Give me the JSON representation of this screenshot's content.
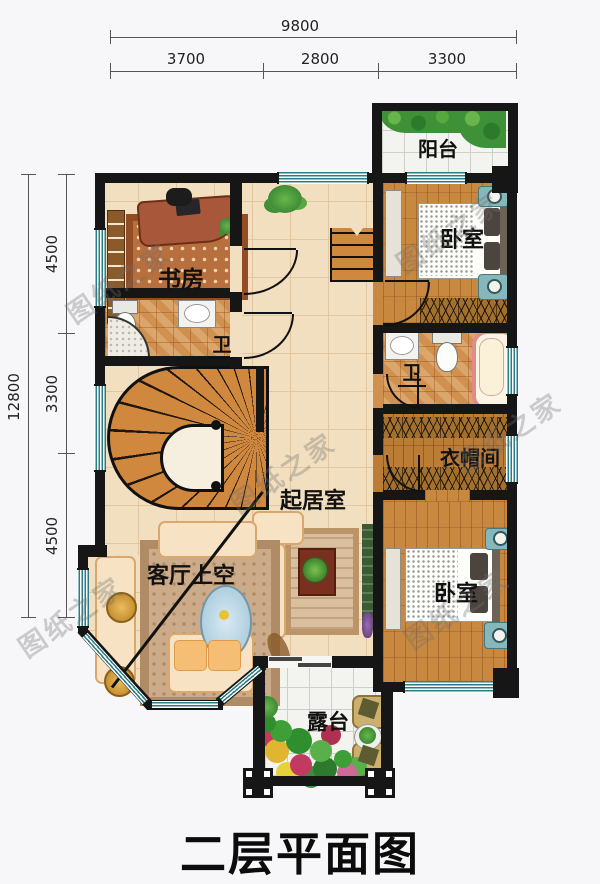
{
  "title": "二层平面图",
  "watermark": "图纸之家",
  "dimensions": {
    "top": {
      "total": "9800",
      "segments": [
        "3700",
        "2800",
        "3300"
      ]
    },
    "left": {
      "total": "12800",
      "segments": [
        "4500",
        "3300",
        "4500"
      ]
    }
  },
  "rooms": {
    "balcony": {
      "label": "阳台"
    },
    "bedroom_top": {
      "label": "卧室"
    },
    "study": {
      "label": "书房"
    },
    "bath_top": {
      "label": "卫"
    },
    "bath_mid": {
      "label": "卫"
    },
    "closet": {
      "label": "衣帽间"
    },
    "living": {
      "label": "起居室"
    },
    "living_void": {
      "label": "客厅上空"
    },
    "bedroom_bottom": {
      "label": "卧室"
    },
    "terrace": {
      "label": "露台"
    }
  },
  "colors": {
    "wall": "#161616",
    "window_teal": "#2a7d85",
    "wood_floor": "#c9883f",
    "cream_floor": "#f2dfc0",
    "bath_tile": "#cf9050",
    "outdoor_tile": "#f3f3f0"
  }
}
